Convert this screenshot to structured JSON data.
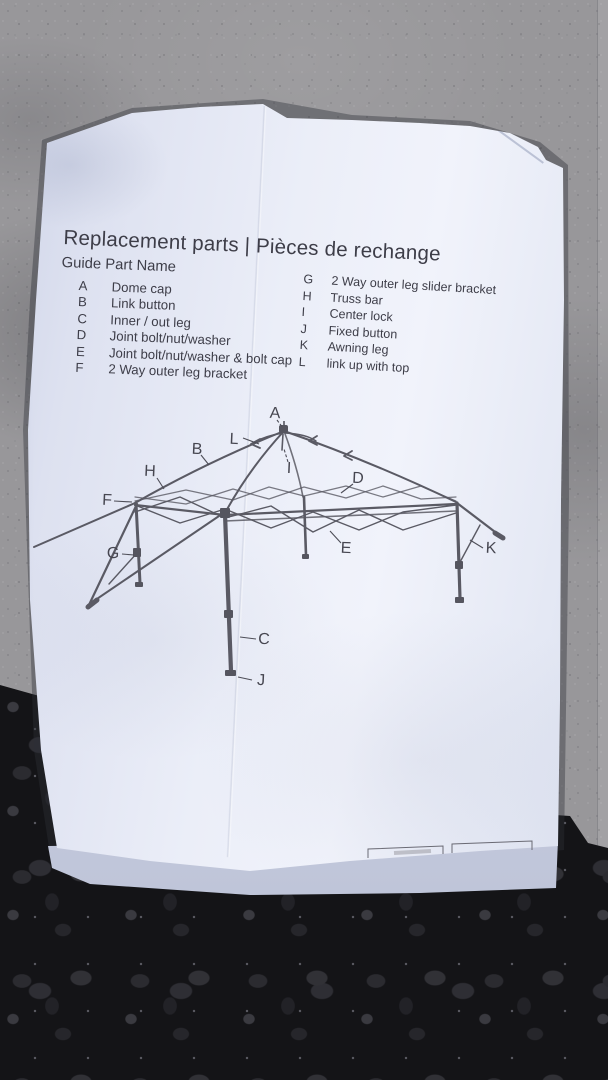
{
  "photo": {
    "scene_description": "printed replacement-parts sheet lying on concrete and gravel",
    "colors": {
      "paper": "#ebeef8",
      "concrete": "#98979a",
      "asphalt": "#141417",
      "ink": "#3d3d48",
      "diagram_line": "#5a5a64"
    }
  },
  "document": {
    "title": "Replacement parts | Pièces de rechange",
    "guide_heading": "Guide Part Name",
    "parts_left": [
      {
        "key": "A",
        "name": "Dome cap"
      },
      {
        "key": "B",
        "name": "Link button"
      },
      {
        "key": "C",
        "name": "Inner / out  leg"
      },
      {
        "key": "D",
        "name": "Joint bolt/nut/washer"
      },
      {
        "key": "E",
        "name": "Joint bolt/nut/washer & bolt cap"
      },
      {
        "key": "F",
        "name": "2 Way outer leg bracket"
      }
    ],
    "parts_right": [
      {
        "key": "G",
        "name": "2 Way outer leg slider bracket"
      },
      {
        "key": "H",
        "name": "Truss bar"
      },
      {
        "key": "I",
        "name": "Center lock"
      },
      {
        "key": "J",
        "name": "Fixed button"
      },
      {
        "key": "K",
        "name": "Awning leg"
      },
      {
        "key": "L",
        "name": "link up with top"
      }
    ]
  },
  "diagram": {
    "description": "line drawing of pop-up canopy frame with lettered callouts",
    "labels": [
      "A",
      "L",
      "B",
      "H",
      "F",
      "G",
      "I",
      "D",
      "E",
      "K",
      "C",
      "J"
    ]
  }
}
